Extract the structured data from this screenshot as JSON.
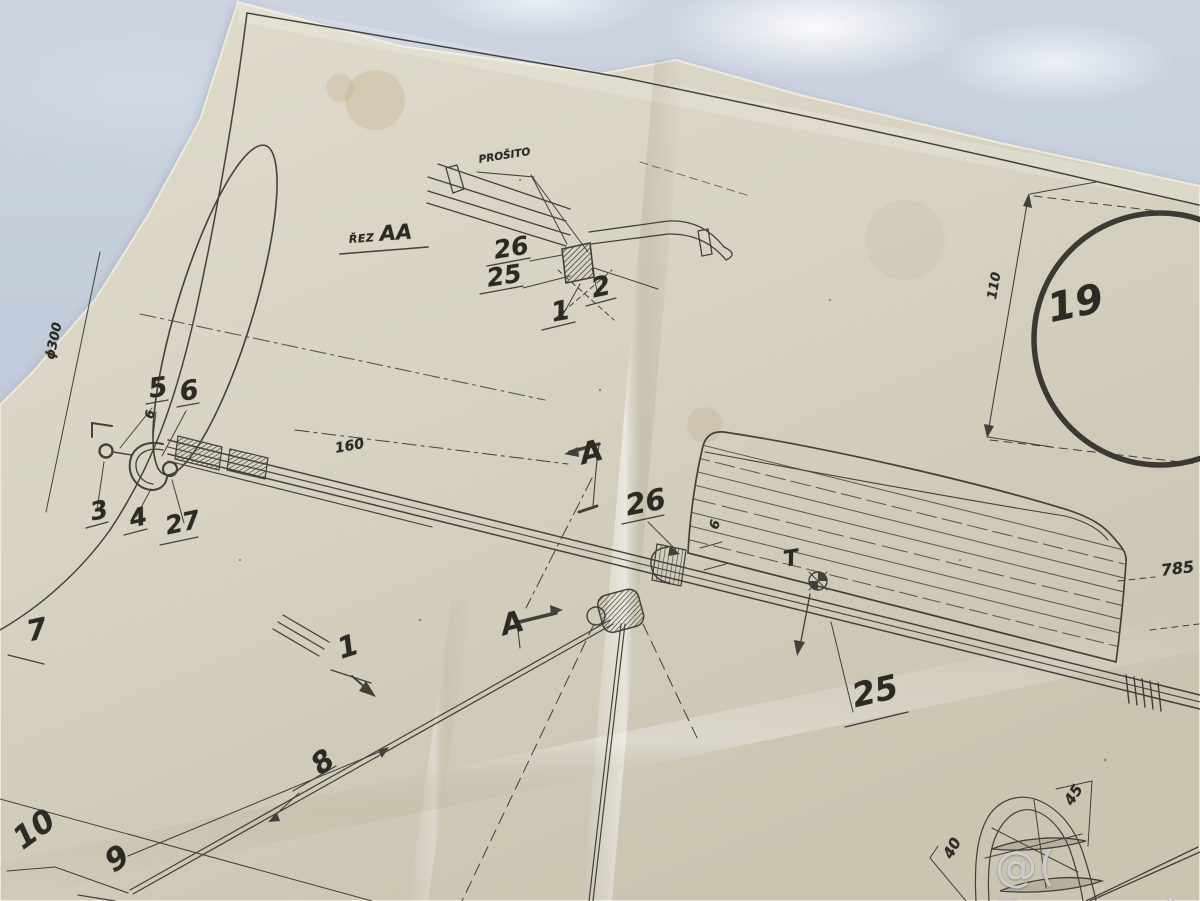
{
  "section": {
    "rez_prefix": "ŘEZ",
    "rez_name": "AA",
    "stitch_label": "PROŠITO"
  },
  "callouts": {
    "c26_top": "26",
    "c25_top": "25",
    "c2": "2",
    "c1_top": "1",
    "c5": "5",
    "c6": "6",
    "c3": "3",
    "c4": "4",
    "c27": "27",
    "c26_mid": "26",
    "c25_bot": "25",
    "c19": "19",
    "c7": "7",
    "c1_mid": "1",
    "c8": "8",
    "c9": "9",
    "c10": "10",
    "a_top": "A",
    "a_bot": "A",
    "t_mark": "T"
  },
  "dimensions": {
    "d160": "160",
    "d6_nose": "6",
    "d6_tail": "6",
    "d110": "110",
    "d785": "785",
    "d45": "45",
    "d40": "40",
    "phi300": "ϕ300"
  },
  "watermark": "@( Bazos.sk"
}
